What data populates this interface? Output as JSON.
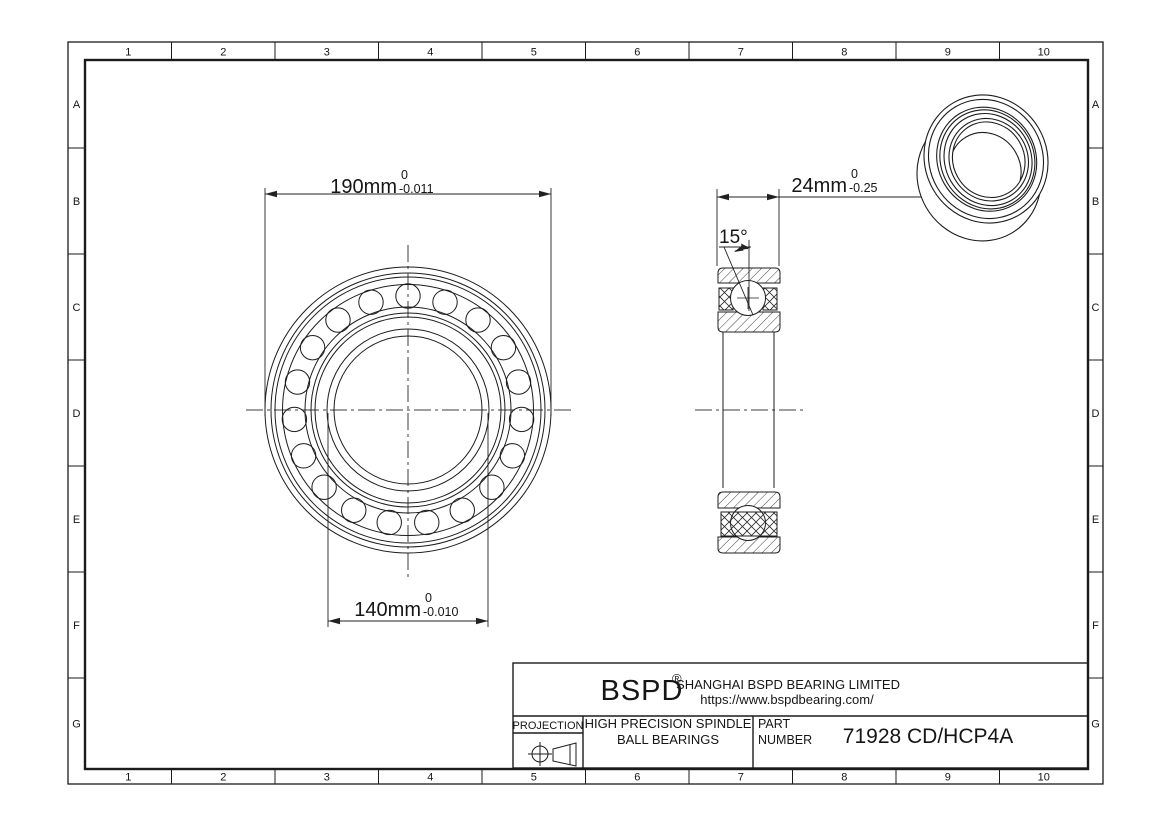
{
  "sheet": {
    "columns": [
      "1",
      "2",
      "3",
      "4",
      "5",
      "6",
      "7",
      "8",
      "9",
      "10"
    ],
    "rows": [
      "A",
      "B",
      "C",
      "D",
      "E",
      "F",
      "G"
    ]
  },
  "dimensions": {
    "outer_diameter": {
      "value": "190mm",
      "tol_upper": "0",
      "tol_lower": "-0.011"
    },
    "bore_diameter": {
      "value": "140mm",
      "tol_upper": "0",
      "tol_lower": "-0.010"
    },
    "width": {
      "value": "24mm",
      "tol_upper": "0",
      "tol_lower": "-0.25"
    },
    "contact_angle": "15°"
  },
  "title_block": {
    "brand": "BSPD",
    "registered": "®",
    "company": "SHANGHAI BSPD BEARING LIMITED",
    "website": "https://www.bspdbearing.com/",
    "projection_label": "PROJECTION",
    "product_line1": "HIGH  PRECISION SPINDLE",
    "product_line2": "BALL BEARINGS",
    "part_label_line1": "PART",
    "part_label_line2": "NUMBER",
    "part_number": "71928 CD/HCP4A"
  },
  "colors": {
    "line": "#1b1b1b",
    "centerline": "#3c3c3c",
    "background": "#ffffff"
  }
}
